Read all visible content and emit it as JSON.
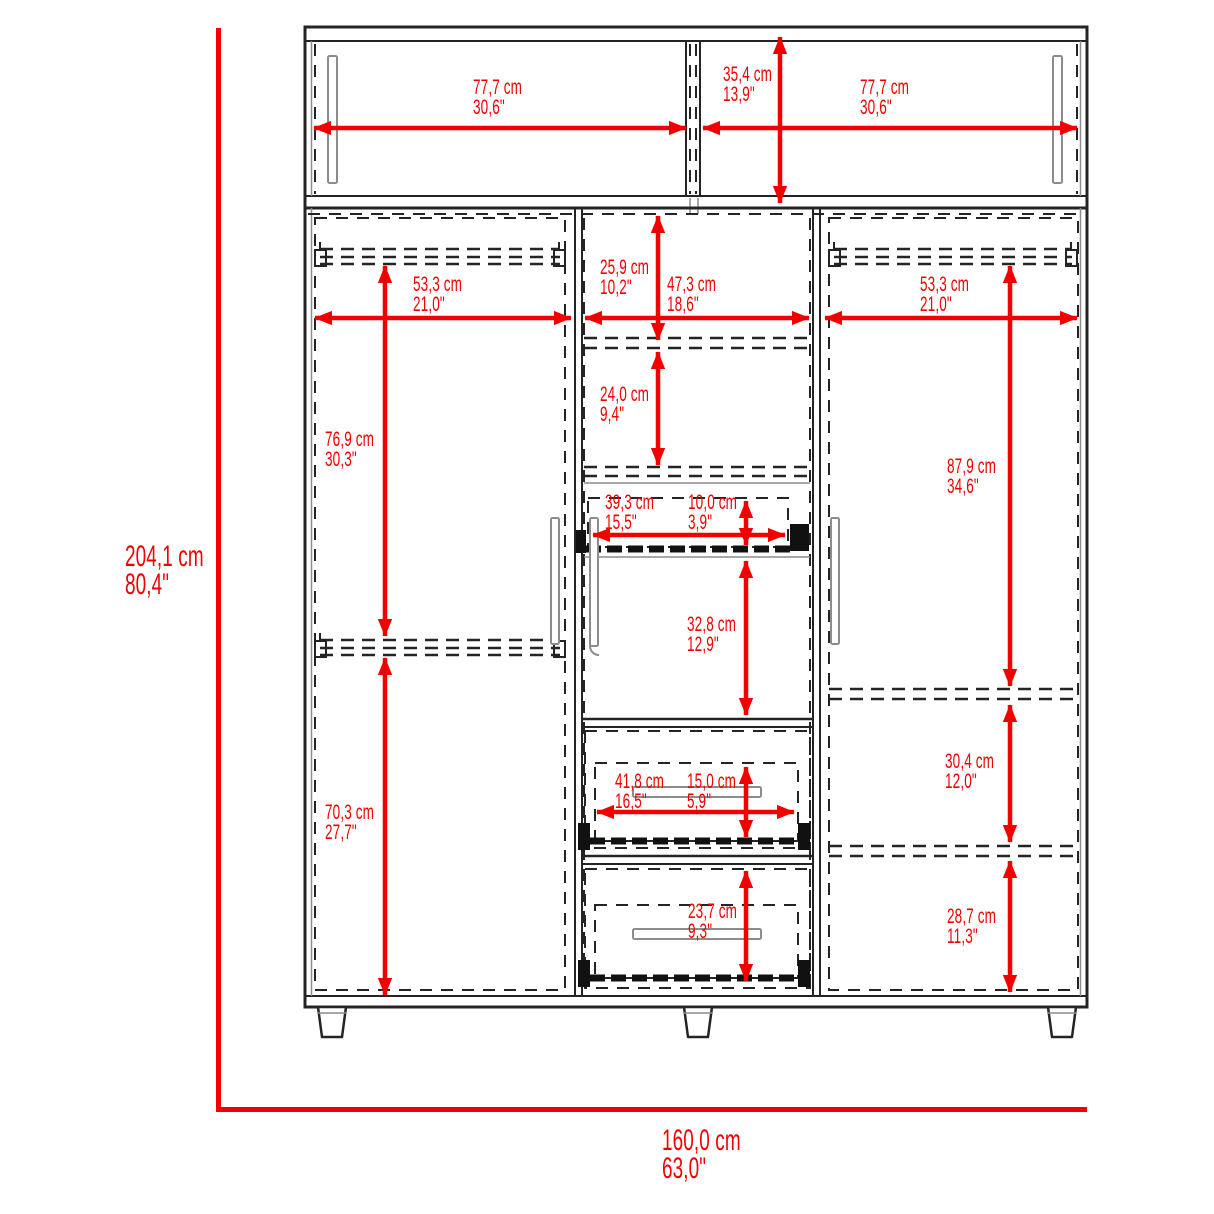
{
  "diagram": {
    "kind": "furniture-dimension-drawing",
    "subject": "wardrobe with top hutch, three sections, hanging rods, pull-out tray and two drawers",
    "units": [
      "cm",
      "inches"
    ],
    "accent_color": "#f20000",
    "line_color": "#242424"
  },
  "dimensions": {
    "overall_height": {
      "cm": "204,1 cm",
      "in": "80,4\""
    },
    "overall_width": {
      "cm": "160,0 cm",
      "in": "63,0\""
    },
    "hutch_left_door_width": {
      "cm": "77,7 cm",
      "in": "30,6\""
    },
    "hutch_height": {
      "cm": "35,4 cm",
      "in": "13,9\""
    },
    "hutch_right_door_width": {
      "cm": "77,7 cm",
      "in": "30,6\""
    },
    "left_section_width": {
      "cm": "53,3 cm",
      "in": "21,0\""
    },
    "center_top_shelf_height": {
      "cm": "25,9 cm",
      "in": "10,2\""
    },
    "center_section_width": {
      "cm": "47,3 cm",
      "in": "18,6\""
    },
    "right_section_width": {
      "cm": "53,3 cm",
      "in": "21,0\""
    },
    "center_second_shelf_height": {
      "cm": "24,0 cm",
      "in": "9,4\""
    },
    "left_upper_section_height": {
      "cm": "76,9 cm",
      "in": "30,3\""
    },
    "right_upper_section_height": {
      "cm": "87,9 cm",
      "in": "34,6\""
    },
    "pullout_tray_width": {
      "cm": "39,3 cm",
      "in": "15,5\""
    },
    "pullout_tray_height": {
      "cm": "10,0 cm",
      "in": "3,9\""
    },
    "center_door_height": {
      "cm": "32,8 cm",
      "in": "12,9\""
    },
    "left_lower_section_height": {
      "cm": "70,3 cm",
      "in": "27,7\""
    },
    "drawer_width": {
      "cm": "41,8 cm",
      "in": "16,5\""
    },
    "top_drawer_height": {
      "cm": "15,0 cm",
      "in": "5,9\""
    },
    "bottom_drawer_height": {
      "cm": "23,7 cm",
      "in": "9,3\""
    },
    "right_middle_section_height": {
      "cm": "30,4 cm",
      "in": "12,0\""
    },
    "right_lower_section_height": {
      "cm": "28,7 cm",
      "in": "11,3\""
    }
  }
}
